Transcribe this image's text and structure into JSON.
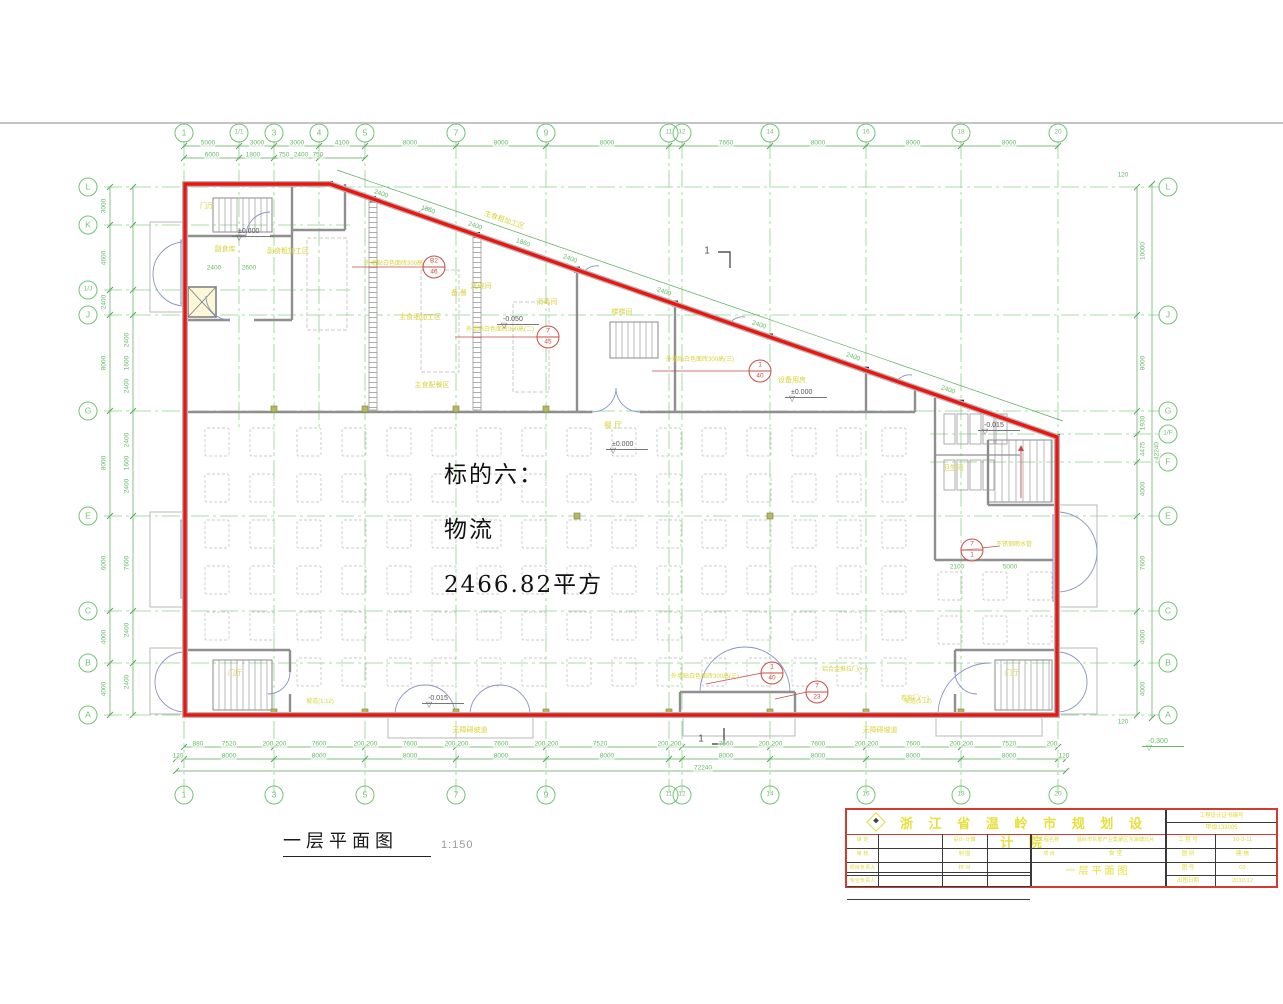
{
  "highlight": {
    "line1": "标的六：",
    "line2": "物流",
    "line3": "2466.82平方"
  },
  "footer": {
    "title": "一层平面图",
    "scale": "1:150"
  },
  "axes": {
    "top": [
      {
        "l": "1",
        "x": 184
      },
      {
        "l": "1/1",
        "x": 239,
        "s": 1
      },
      {
        "l": "3",
        "x": 274
      },
      {
        "l": "4",
        "x": 319,
        "s": 1
      },
      {
        "l": "5",
        "x": 365
      },
      {
        "l": "7",
        "x": 456
      },
      {
        "l": "9",
        "x": 546
      },
      {
        "l": "11",
        "x": 669
      },
      {
        "l": "12",
        "x": 682
      },
      {
        "l": "14",
        "x": 770
      },
      {
        "l": "16",
        "x": 866
      },
      {
        "l": "18",
        "x": 961
      },
      {
        "l": "20",
        "x": 1058
      }
    ],
    "bottom": [
      {
        "l": "1",
        "x": 184
      },
      {
        "l": "3",
        "x": 274
      },
      {
        "l": "5",
        "x": 365
      },
      {
        "l": "7",
        "x": 456
      },
      {
        "l": "9",
        "x": 546
      },
      {
        "l": "11",
        "x": 669
      },
      {
        "l": "12",
        "x": 682
      },
      {
        "l": "14",
        "x": 770
      },
      {
        "l": "16",
        "x": 866
      },
      {
        "l": "18",
        "x": 961
      },
      {
        "l": "20",
        "x": 1058
      }
    ],
    "left": [
      {
        "l": "L",
        "y": 187
      },
      {
        "l": "K",
        "y": 225,
        "s": 1
      },
      {
        "l": "1/J",
        "y": 290,
        "s": 1
      },
      {
        "l": "J",
        "y": 315
      },
      {
        "l": "G",
        "y": 411
      },
      {
        "l": "E",
        "y": 516
      },
      {
        "l": "C",
        "y": 611
      },
      {
        "l": "B",
        "y": 663
      },
      {
        "l": "A",
        "y": 715
      }
    ],
    "right": [
      {
        "l": "L",
        "y": 187
      },
      {
        "l": "J",
        "y": 315
      },
      {
        "l": "G",
        "y": 411
      },
      {
        "l": "1/F",
        "y": 434,
        "s": 1
      },
      {
        "l": "F",
        "y": 462,
        "s": 1
      },
      {
        "l": "E",
        "y": 516
      },
      {
        "l": "C",
        "y": 611
      },
      {
        "l": "B",
        "y": 663
      },
      {
        "l": "A",
        "y": 715
      }
    ]
  },
  "dimensions": [
    [
      "5000",
      208,
      143
    ],
    [
      "3000",
      257,
      143
    ],
    [
      "3000",
      297,
      143
    ],
    [
      "4100",
      342,
      143
    ],
    [
      "8000",
      410,
      143
    ],
    [
      "8000",
      501,
      143
    ],
    [
      "8000",
      607,
      143
    ],
    [
      "7660",
      726,
      143
    ],
    [
      "8000",
      818,
      143
    ],
    [
      "8000",
      913,
      143
    ],
    [
      "8000",
      1009,
      143
    ],
    [
      "6000",
      212,
      155
    ],
    [
      "1800",
      253,
      155
    ],
    [
      "750",
      284,
      155
    ],
    [
      "2400",
      301,
      155
    ],
    [
      "750",
      318,
      155
    ],
    [
      "2400",
      381,
      194,
      19
    ],
    [
      "1860",
      428,
      210,
      19
    ],
    [
      "2400",
      475,
      226,
      19
    ],
    [
      "1860",
      523,
      243,
      19
    ],
    [
      "2400",
      570,
      259,
      19
    ],
    [
      "2400",
      664,
      292,
      19
    ],
    [
      "2400",
      759,
      325,
      19
    ],
    [
      "2400",
      853,
      357,
      19
    ],
    [
      "2400",
      948,
      390,
      19
    ],
    [
      "880",
      198,
      744
    ],
    [
      "7520",
      229,
      744
    ],
    [
      "200",
      268,
      744
    ],
    [
      "200",
      281,
      744
    ],
    [
      "7600",
      319,
      744
    ],
    [
      "200",
      359,
      744
    ],
    [
      "200",
      372,
      744
    ],
    [
      "7600",
      410,
      744
    ],
    [
      "200",
      450,
      744
    ],
    [
      "200",
      463,
      744
    ],
    [
      "7600",
      501,
      744
    ],
    [
      "200",
      540,
      744
    ],
    [
      "200",
      553,
      744
    ],
    [
      "7520",
      600,
      744
    ],
    [
      "200",
      663,
      744
    ],
    [
      "200",
      676,
      744
    ],
    [
      "7660",
      726,
      744
    ],
    [
      "200",
      764,
      744
    ],
    [
      "200",
      777,
      744
    ],
    [
      "7600",
      818,
      744
    ],
    [
      "200",
      860,
      744
    ],
    [
      "200",
      873,
      744
    ],
    [
      "7600",
      913,
      744
    ],
    [
      "200",
      955,
      744
    ],
    [
      "200",
      968,
      744
    ],
    [
      "7520",
      1009,
      744
    ],
    [
      "200",
      1052,
      744
    ],
    [
      "120",
      178,
      756
    ],
    [
      "8000",
      229,
      756
    ],
    [
      "8000",
      319,
      756
    ],
    [
      "8000",
      410,
      756
    ],
    [
      "8000",
      501,
      756
    ],
    [
      "8000",
      607,
      756
    ],
    [
      "8000",
      726,
      756
    ],
    [
      "8000",
      818,
      756
    ],
    [
      "8000",
      913,
      756
    ],
    [
      "8000",
      1009,
      756
    ],
    [
      "120",
      1064,
      756
    ],
    [
      "72240",
      703,
      768
    ],
    [
      "3000",
      104,
      206,
      -90
    ],
    [
      "4600",
      104,
      258,
      -90
    ],
    [
      "2400",
      104,
      302,
      -90
    ],
    [
      "8000",
      104,
      363,
      -90
    ],
    [
      "8000",
      104,
      463,
      -90
    ],
    [
      "6000",
      104,
      563,
      -90
    ],
    [
      "4000",
      104,
      637,
      -90
    ],
    [
      "4000",
      104,
      689,
      -90
    ],
    [
      "2400",
      127,
      340,
      -90
    ],
    [
      "1600",
      127,
      363,
      -90
    ],
    [
      "2400",
      127,
      386,
      -90
    ],
    [
      "2400",
      127,
      440,
      -90
    ],
    [
      "1600",
      127,
      463,
      -90
    ],
    [
      "2400",
      127,
      486,
      -90
    ],
    [
      "7600",
      127,
      563,
      -90
    ],
    [
      "2400",
      127,
      630,
      -90
    ],
    [
      "2400",
      127,
      682,
      -90
    ],
    [
      "10000",
      1143,
      251,
      -90
    ],
    [
      "8000",
      1143,
      363,
      -90
    ],
    [
      "1930",
      1143,
      423,
      -90
    ],
    [
      "4475",
      1143,
      449,
      -90
    ],
    [
      "4000",
      1143,
      489,
      -90
    ],
    [
      "7600",
      1143,
      563,
      -90
    ],
    [
      "4000",
      1143,
      637,
      -90
    ],
    [
      "4000",
      1143,
      689,
      -90
    ],
    [
      "42240",
      1157,
      451,
      -90
    ],
    [
      "120",
      1123,
      175
    ],
    [
      "120",
      1123,
      722
    ],
    [
      "2100",
      957,
      567
    ],
    [
      "5000",
      1010,
      567
    ],
    [
      "2400",
      214,
      268
    ],
    [
      "2600",
      249,
      268
    ]
  ],
  "room_labels": [
    {
      "t": "门厅",
      "x": 207,
      "y": 207
    },
    {
      "t": "副食库",
      "x": 225,
      "y": 250
    },
    {
      "t": "副食粗加工区",
      "x": 288,
      "y": 252
    },
    {
      "t": "主食粗加工区",
      "x": 504,
      "y": 221,
      "r": 19
    },
    {
      "t": "洗碗间",
      "x": 481,
      "y": 287
    },
    {
      "t": "备 餐",
      "x": 459,
      "y": 294
    },
    {
      "t": "消毒间",
      "x": 547,
      "y": 303
    },
    {
      "t": "主食细加工区",
      "x": 420,
      "y": 318
    },
    {
      "t": "主食配餐区",
      "x": 432,
      "y": 386
    },
    {
      "t": "楼梯间",
      "x": 622,
      "y": 313
    },
    {
      "t": "外墙贴白色面砖300高(二)",
      "x": 399,
      "y": 264,
      "fs": 6
    },
    {
      "t": "外墙贴白色面砖300高(二)",
      "x": 500,
      "y": 330,
      "fs": 6
    },
    {
      "t": "外墙贴白色面砖300高(三)",
      "x": 700,
      "y": 360,
      "fs": 6
    },
    {
      "t": "设备用房",
      "x": 792,
      "y": 381
    },
    {
      "t": "餐 厅",
      "x": 613,
      "y": 426,
      "fs": 8
    },
    {
      "t": "卫生间",
      "x": 953,
      "y": 469
    },
    {
      "t": "不锈钢雨水管",
      "x": 1014,
      "y": 545,
      "fs": 6
    },
    {
      "t": "外墙贴白色面砖300高(三)",
      "x": 705,
      "y": 677,
      "fs": 6
    },
    {
      "t": "铝合金推拉门(一)",
      "x": 845,
      "y": 670,
      "fs": 6
    },
    {
      "t": "卷帘门(一)",
      "x": 915,
      "y": 699,
      "fs": 6
    },
    {
      "t": "无障碍坡道",
      "x": 470,
      "y": 731
    },
    {
      "t": "无障碍坡道",
      "x": 880,
      "y": 731
    },
    {
      "t": "门厅",
      "x": 235,
      "y": 674
    },
    {
      "t": "坡道(1:12)",
      "x": 320,
      "y": 702,
      "fs": 6
    },
    {
      "t": "坡道(1:12)",
      "x": 918,
      "y": 702,
      "fs": 6
    },
    {
      "t": "门厅",
      "x": 1012,
      "y": 674
    }
  ],
  "levels": [
    {
      "t": "±0.000",
      "x": 238,
      "y": 228
    },
    {
      "t": "-0.050",
      "x": 503,
      "y": 316
    },
    {
      "t": "±0.000",
      "x": 612,
      "y": 441
    },
    {
      "t": "±0.000",
      "x": 791,
      "y": 389
    },
    {
      "t": "-0.015",
      "x": 984,
      "y": 422
    },
    {
      "t": "-0.015",
      "x": 428,
      "y": 695
    },
    {
      "t": "-0.300",
      "x": 1148,
      "y": 738,
      "c": "#67b967"
    }
  ],
  "callouts": [
    {
      "top": "B2",
      "bot": "46",
      "x": 434,
      "y": 267,
      "lx": 352,
      "ly": 267
    },
    {
      "top": "7",
      "bot": "45",
      "x": 548,
      "y": 337,
      "lx": 455,
      "ly": 337
    },
    {
      "top": "1",
      "bot": "40",
      "x": 760,
      "y": 371,
      "lx": 652,
      "ly": 371
    },
    {
      "top": "1",
      "bot": "40",
      "x": 772,
      "y": 673,
      "lx": 706,
      "ly": 684
    },
    {
      "top": "7",
      "bot": "23",
      "x": 817,
      "y": 692,
      "lx": 775,
      "ly": 699
    },
    {
      "top": "7",
      "bot": "1",
      "x": 972,
      "y": 550,
      "lx": 1000,
      "ly": 546
    }
  ],
  "section_marks": [
    {
      "t": "1",
      "x": 707,
      "y": 251
    },
    {
      "t": "1",
      "x": 701,
      "y": 739
    }
  ],
  "titleblock": {
    "institute": "浙 江 省 温 岭 市 规 划 设 计 院",
    "cert_label": "工程设计证书编号",
    "cert_no": "甲级133005",
    "left_rows": [
      {
        "l": "审 定",
        "v": ""
      },
      {
        "l": "审 核",
        "v": ""
      },
      {
        "l": "项目负责人",
        "v": ""
      },
      {
        "l": "专业负责人",
        "v": ""
      }
    ],
    "mid_rows": [
      {
        "l": "设计·计算",
        "v": ""
      },
      {
        "l": "制 图",
        "v": ""
      },
      {
        "l": "校 对",
        "v": ""
      },
      {
        "l": "",
        "v": ""
      }
    ],
    "project_label": "工程名称",
    "project_name": "温岭市东部产业集聚区东海塘北片",
    "item_label": "项 目",
    "item_value": "食 堂",
    "drawing_title": "一层平面图",
    "right_rows": [
      {
        "l": "工 程 号",
        "v": "10-3-11"
      },
      {
        "l": "图 别",
        "v": "建 施"
      },
      {
        "l": "图 号",
        "v": "03"
      },
      {
        "l": "出图日期",
        "v": "2010.12"
      }
    ]
  },
  "colors": {
    "grid_green": "#8ed28e",
    "dim_green": "#67b967",
    "label_yellow": "#d8d23a",
    "boundary_red": "#ee1511",
    "callout_red": "#c74b44",
    "wall_gray": "#8f8f8f"
  }
}
